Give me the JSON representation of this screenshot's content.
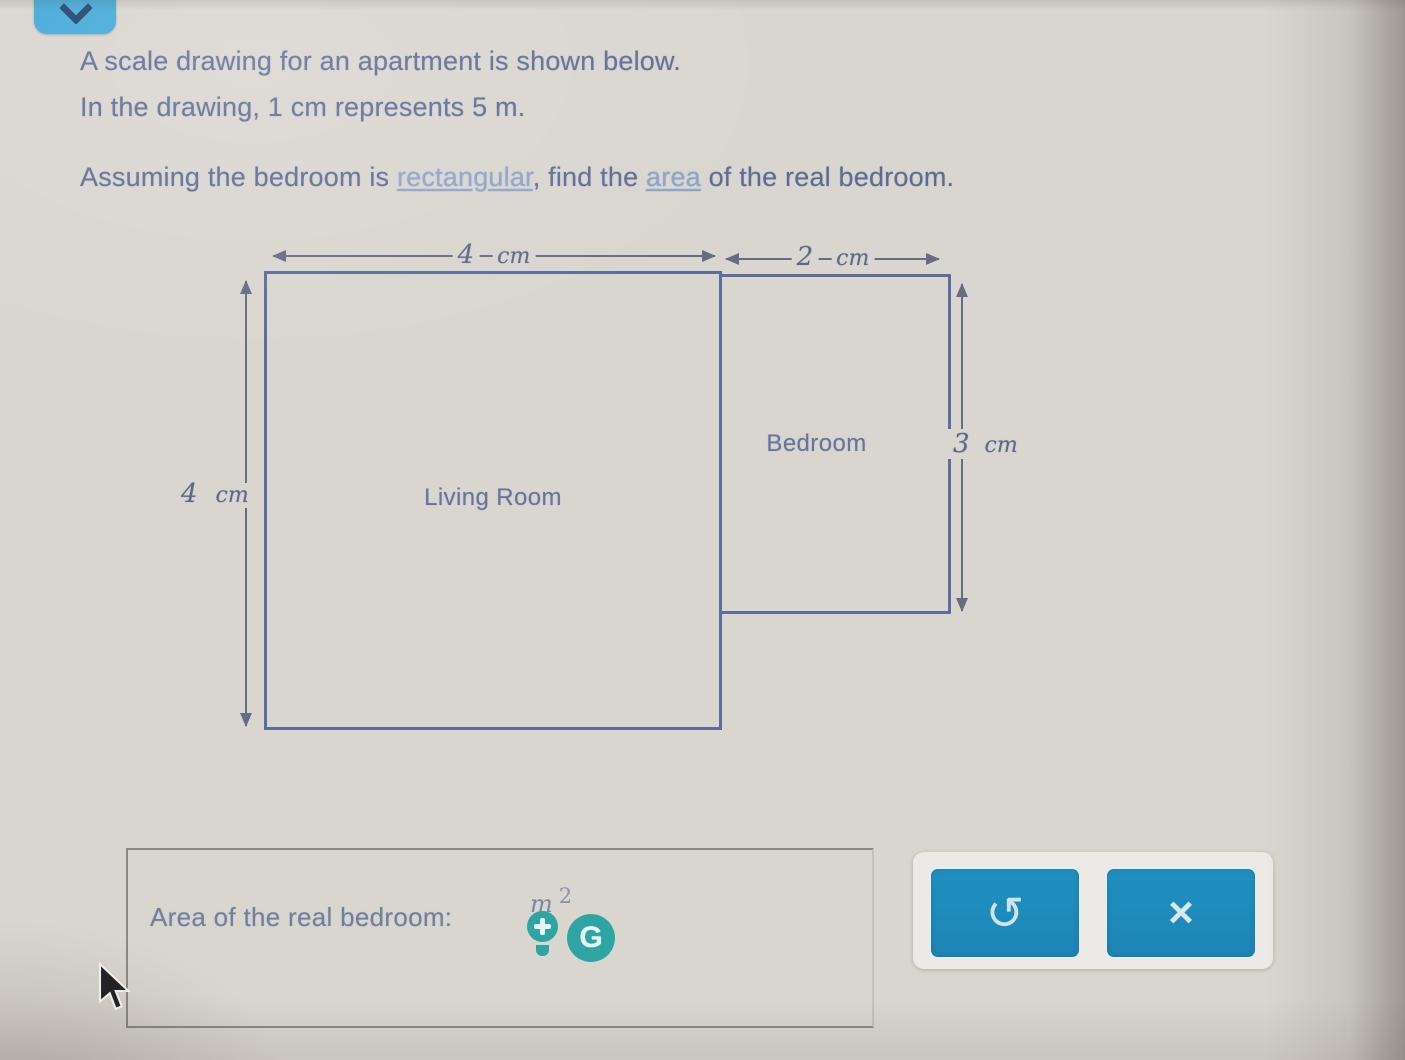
{
  "header": {
    "collapse_button_icon": "chevron-down"
  },
  "problem": {
    "line1": "A scale drawing for an apartment is shown below.",
    "line2": "In the drawing, 1 cm represents 5 m.",
    "line3_pre": "Assuming the bedroom is ",
    "line3_link1": "rectangular",
    "line3_mid": ", find the ",
    "line3_link2": "area",
    "line3_post": " of the real bedroom."
  },
  "diagram": {
    "living_room": {
      "label": "Living Room",
      "width_value": "4",
      "width_unit": "cm",
      "height_value": "4",
      "height_unit": "cm"
    },
    "bedroom": {
      "label": "Bedroom",
      "width_value": "2",
      "width_unit": "cm",
      "height_value": "3",
      "height_unit": "cm"
    }
  },
  "answer": {
    "label": "Area of the real bedroom:",
    "unit_base": "m",
    "unit_exponent": "2",
    "g_icon_letter": "G",
    "icons": [
      "lightbulb-plus-icon",
      "g-circle-icon"
    ]
  },
  "keypad": {
    "undo_glyph": "↺",
    "multiply_glyph": "×"
  },
  "colors": {
    "background": "#d9d5cf",
    "accent_blue_button": "#1e8cbd",
    "collapse_blue": "#41a7d8",
    "teal_icon": "#2ea5a2",
    "text_blue": "#5d6c95",
    "link_blue": "#8aa5cd",
    "shape_border": "#5b6c9d",
    "arrow_gray": "#666c82"
  }
}
